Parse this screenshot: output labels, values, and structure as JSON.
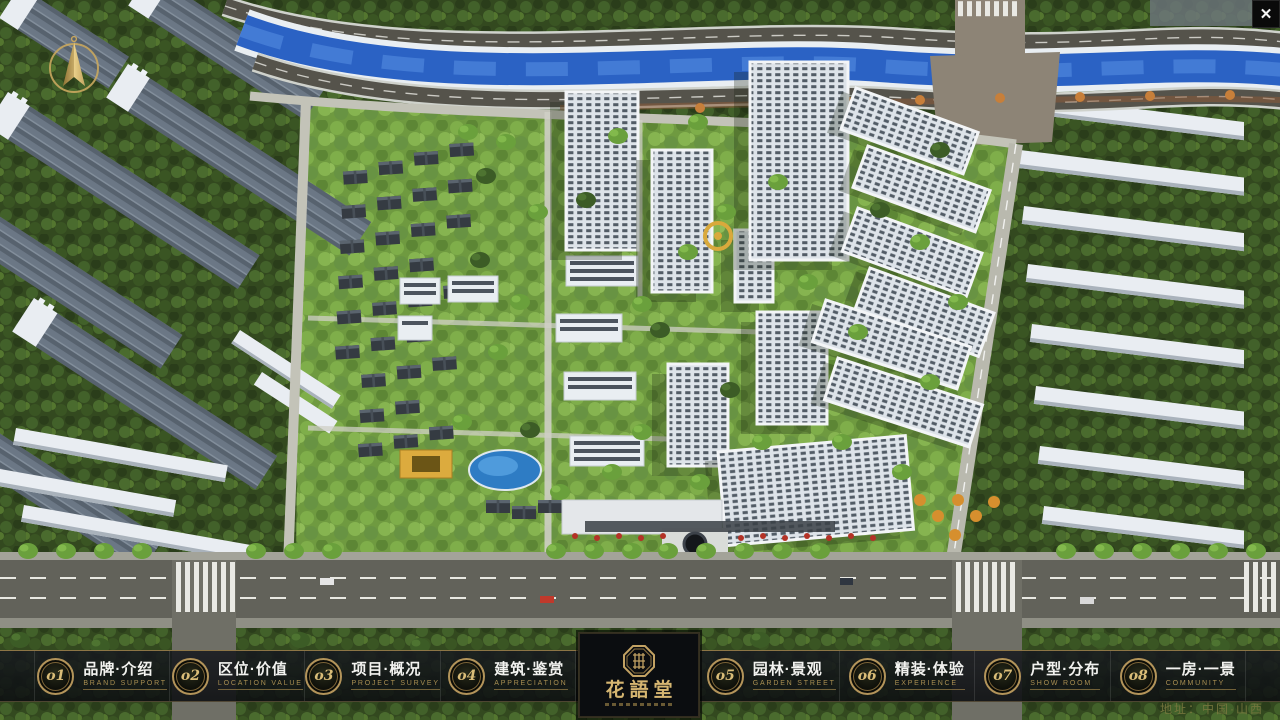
{
  "window": {
    "close_glyph": "✕"
  },
  "nav": {
    "items": [
      {
        "num": "o1",
        "title": "品牌·介绍",
        "subtitle": "BRAND SUPPORT"
      },
      {
        "num": "o2",
        "title": "区位·价值",
        "subtitle": "LOCATION VALUE"
      },
      {
        "num": "o3",
        "title": "项目·概况",
        "subtitle": "PROJECT SURVEY"
      },
      {
        "num": "o4",
        "title": "建筑·鉴赏",
        "subtitle": "APPRECIATION"
      },
      {
        "num": "o5",
        "title": "园林·景观",
        "subtitle": "GARDEN STREET"
      },
      {
        "num": "o6",
        "title": "精装·体验",
        "subtitle": "EXPERIENCE"
      },
      {
        "num": "o7",
        "title": "户型·分布",
        "subtitle": "SHOW ROOM"
      },
      {
        "num": "o8",
        "title": "一房·一景",
        "subtitle": "COMMUNITY"
      }
    ]
  },
  "logo": {
    "title": "花語堂"
  },
  "footer": {
    "address": "地址：中国·山西"
  },
  "colors": {
    "gold": "#c5a363",
    "nav_bg": "#101217",
    "river": "#2b62c4"
  }
}
